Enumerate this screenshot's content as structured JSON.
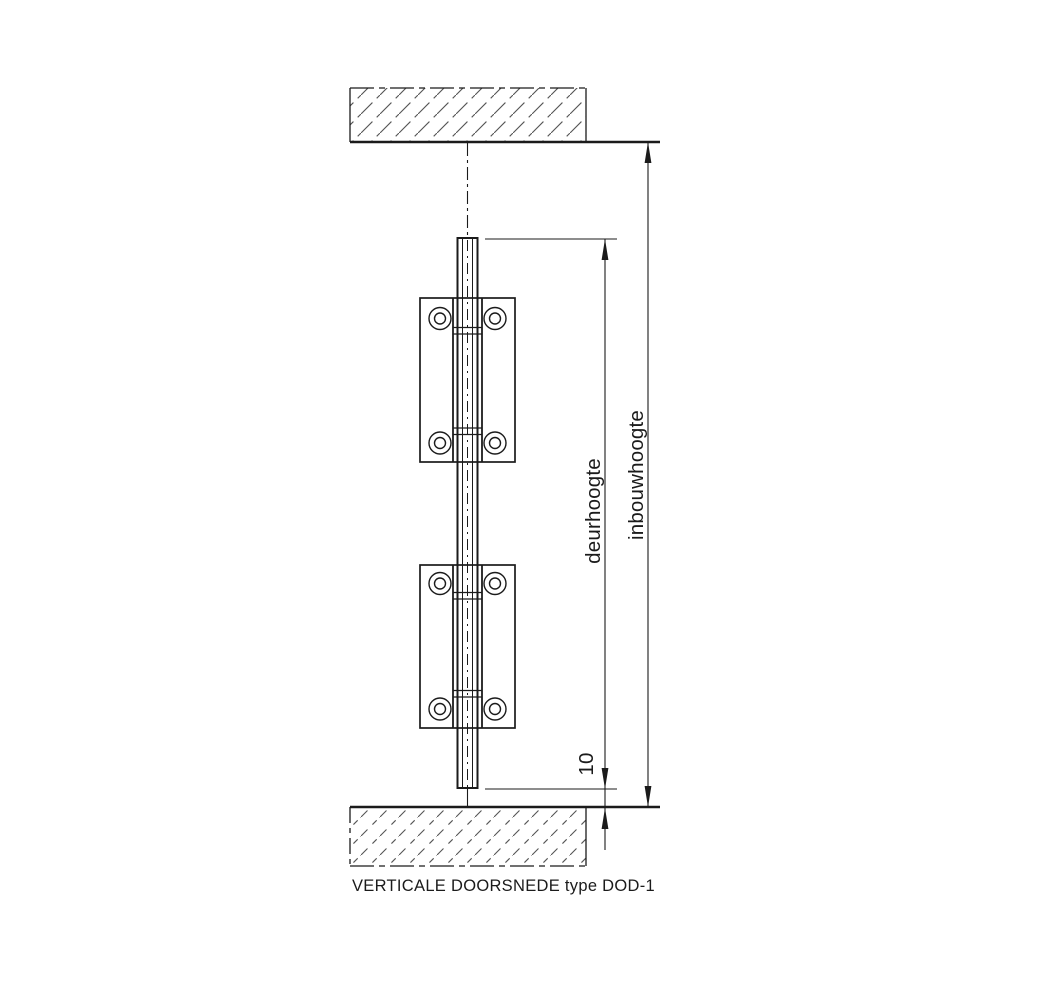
{
  "drawing": {
    "caption": "VERTICALE DOORSNEDE type DOD-1",
    "dimensions": {
      "door_height_label": "deurhoogte",
      "installation_height_label": "inbouwhoogte",
      "floor_gap_value": "10"
    },
    "colors": {
      "ink": "#1b1b1b",
      "hatch": "#555555",
      "background": "#ffffff"
    }
  }
}
